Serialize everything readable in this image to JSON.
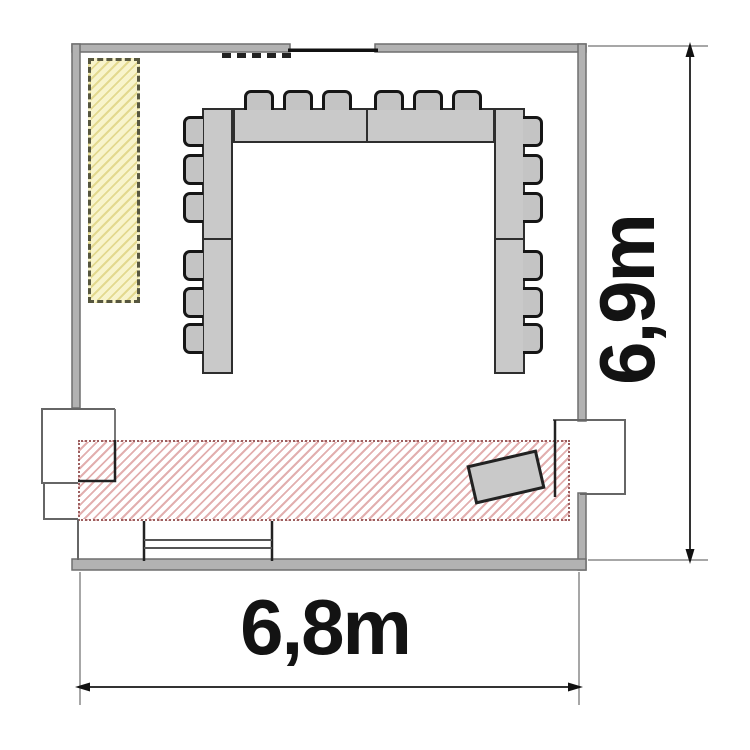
{
  "diagram_type": "room floor plan with U-shaped conference table",
  "labels": {
    "height_dimension": "6,9m",
    "width_dimension": "6,8m"
  },
  "furniture": {
    "u_table_segments": 6,
    "seats": {
      "top": 6,
      "left": 6,
      "right": 6,
      "total": 18
    },
    "tilted_rectangle_count": 1
  },
  "zones": {
    "yellow_hatched_zone_count": 1,
    "red_hatched_zone_count": 1
  },
  "colors": {
    "wall": "#b2b2b2",
    "wall-edge": "#6f6f6f",
    "line-dark": "#222222",
    "table-fill": "#c9c9c9",
    "table-border": "#2e2e2e",
    "chair-fill": "#c4c4c4",
    "chair-border": "#161616",
    "yellow-fill": "#f8f4cc",
    "yellow-hatch": "#e3d98f",
    "yellow-border": "#56563e",
    "red-hatch": "#e2afaf",
    "red-border": "#9c5f5f",
    "dim-line": "#333333",
    "ext-line": "#8a8a8a",
    "text": "#131313"
  }
}
